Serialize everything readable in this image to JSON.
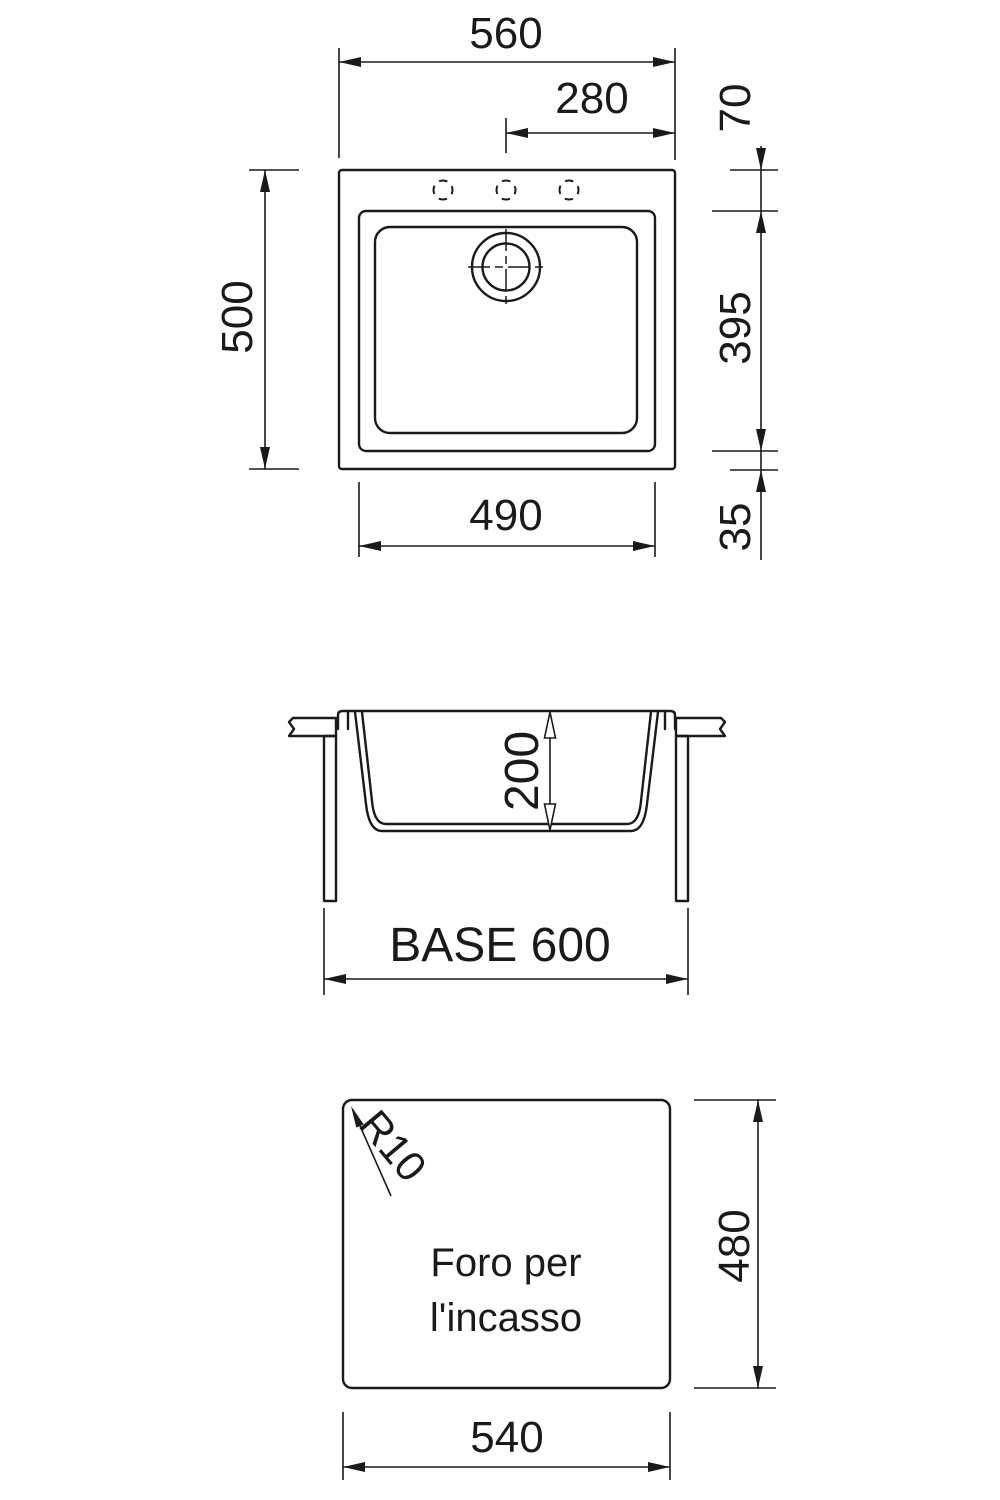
{
  "colors": {
    "ink": "#1a1a1a",
    "paper": "#ffffff"
  },
  "top_view": {
    "overall_width": "560",
    "tap_to_edge": "280",
    "overall_depth": "500",
    "edge_to_bowl": "70",
    "bowl_length": "395",
    "bowl_to_front": "35",
    "bowl_width": "490"
  },
  "section_view": {
    "bowl_depth": "200",
    "base_label": "BASE 600"
  },
  "cutout_view": {
    "corner_radius": "R10",
    "cutout_depth": "480",
    "cutout_width": "540",
    "note_line1": "Foro per",
    "note_line2": "l'incasso"
  }
}
